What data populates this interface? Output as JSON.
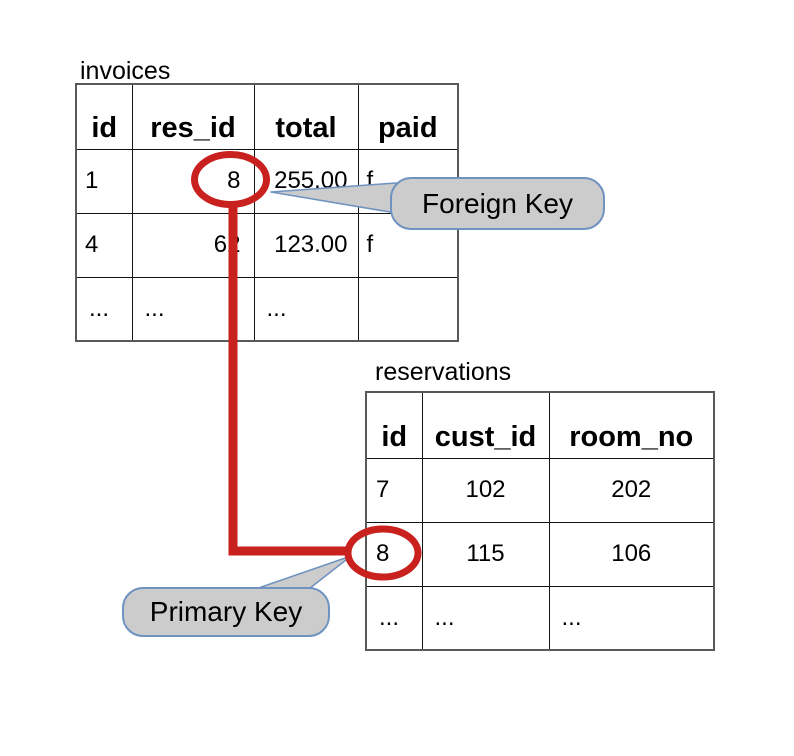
{
  "diagram_title": "foreign key / primary key relationship",
  "tables": [
    {
      "name": "invoices",
      "columns": [
        "id",
        "res_id",
        "total",
        "paid"
      ],
      "rows": [
        [
          "1",
          "8",
          "255.00",
          "f"
        ],
        [
          "4",
          "62",
          "123.00",
          "f"
        ],
        [
          "...",
          "...",
          "...",
          ""
        ]
      ]
    },
    {
      "name": "reservations",
      "columns": [
        "id",
        "cust_id",
        "room_no"
      ],
      "rows": [
        [
          "7",
          "102",
          "202"
        ],
        [
          "8",
          "115",
          "106"
        ],
        [
          "...",
          "...",
          "..."
        ]
      ]
    }
  ],
  "callouts": [
    {
      "label": "Foreign Key",
      "highlighted_value": "8",
      "highlighted_column": "res_id"
    },
    {
      "label": "Primary Key",
      "highlighted_value": "8",
      "highlighted_column": "id"
    }
  ],
  "colors": {
    "highlight_red": "#c9211e",
    "callout_fill": "#cccccc",
    "callout_border": "#6f92c0",
    "table_border_outer": "#595959",
    "table_border_inner": "#141414",
    "page_bg": "#ffffff",
    "text_color": "#000000"
  }
}
